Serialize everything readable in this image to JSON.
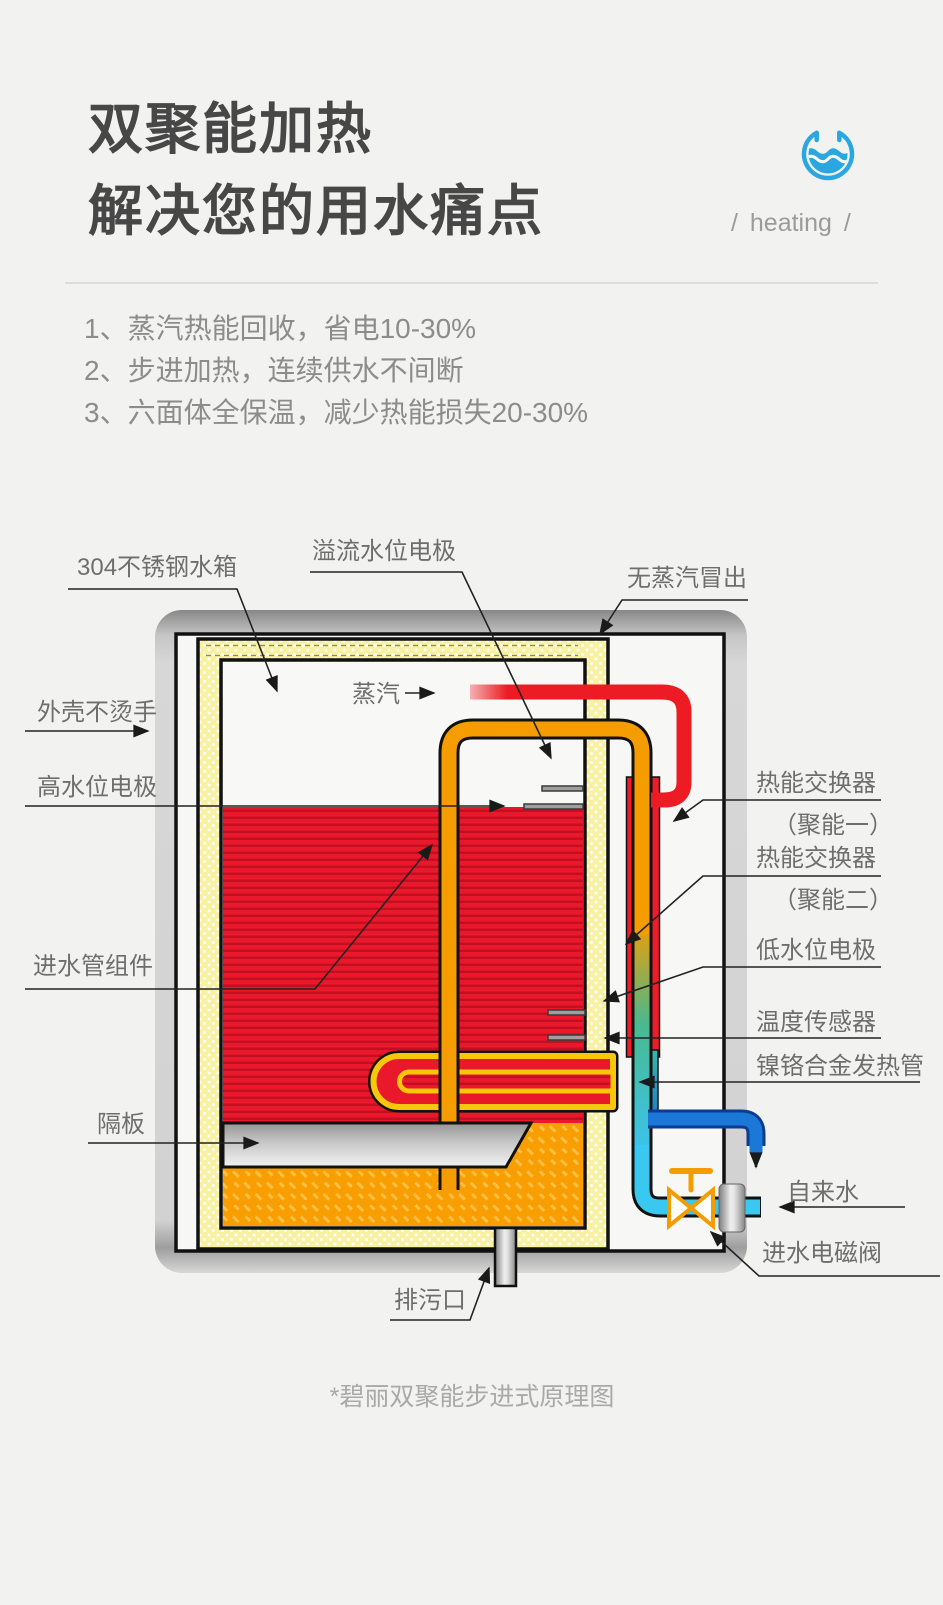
{
  "header": {
    "title_line1": "双聚能加热",
    "title_line2": "解决您的用水痛点",
    "tagline": "/ heating /",
    "icon": "water-cup-icon",
    "icon_color": "#2aa7e1"
  },
  "benefits": [
    "1、蒸汽热能回收，省电10-30%",
    "2、步进加热，连续供水不间断",
    "3、六面体全保温，减少热能损失20-30%"
  ],
  "diagram": {
    "labels": {
      "tank": "304不锈钢水箱",
      "overflow_electrode": "溢流水位电极",
      "no_steam": "无蒸汽冒出",
      "steam": "蒸汽",
      "cool_shell": "外壳不烫手",
      "high_level_electrode": "高水位电极",
      "inlet_pipe_assembly": "进水管组件",
      "baffle": "隔板",
      "drain_outlet": "排污口",
      "heat_exchanger_1": "热能交换器",
      "heat_exchanger_1_sub": "（聚能一）",
      "heat_exchanger_2": "热能交换器",
      "heat_exchanger_2_sub": "（聚能二）",
      "low_level_electrode": "低水位电极",
      "temp_sensor": "温度传感器",
      "heating_tube": "镍铬合金发热管",
      "tap_water": "自来水",
      "inlet_solenoid_valve": "进水电磁阀"
    },
    "caption": "*碧丽双聚能步进式原理图",
    "colors": {
      "hot_water": "#e9182b",
      "inlet_pipe_orange": "#f59c00",
      "cold_water_cyan": "#38c8f0",
      "outlet_pipe_blue": "#1c78d6",
      "insulation_yellow": "#f8f1a2",
      "valve_orange": "#f59c00",
      "warm_zone_orange": "#f99e00"
    }
  }
}
